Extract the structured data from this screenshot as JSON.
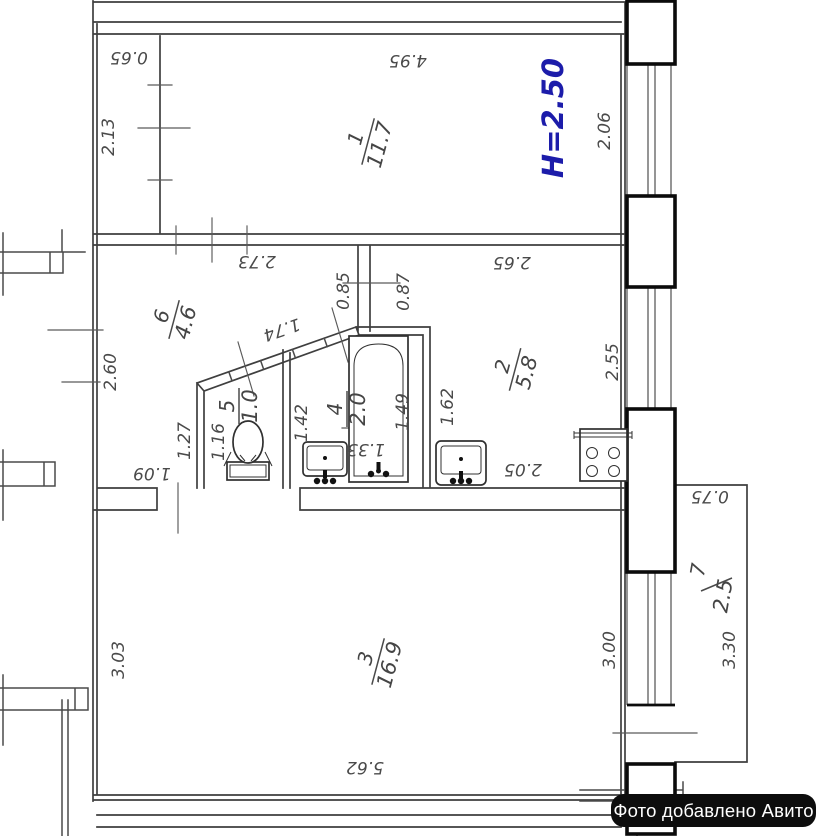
{
  "meta": {
    "badge_text": "Фото добавлено Авито"
  },
  "colors": {
    "accent_blue": "#1c1caa",
    "line": "#3f3f3f",
    "pier_black": "#0b0b0b",
    "badge_bg": "#0d0d0d",
    "badge_text": "#ffffff"
  },
  "ceiling_height": "H=2.50",
  "rooms": [
    {
      "number": "1",
      "area": "11.7"
    },
    {
      "number": "2",
      "area": "5.8"
    },
    {
      "number": "3",
      "area": "16.9"
    },
    {
      "number": "4",
      "area": "2.0"
    },
    {
      "number": "5",
      "area": "1.0"
    },
    {
      "number": "6",
      "area": "4.6"
    },
    {
      "number": "7",
      "area": "2.5"
    }
  ],
  "dimensions": {
    "strip_width": "0.65",
    "room1_width": "4.95",
    "room1_side": "2.13",
    "window_room1": "2.06",
    "corridor_top": "2.73",
    "kitchen_top": "2.65",
    "corridor_left": "2.60",
    "passage_left": "0.85",
    "passage_right": "0.87",
    "diagonal_wall": "1.74",
    "wc_offset": "1.27",
    "wc_width": "1.16",
    "bath_sink_width": "1.42",
    "bath_mid": "1.33",
    "tub_length": "1.49",
    "kitchen_sink_width": "1.62",
    "kitchen_bottom": "2.05",
    "kitchen_window": "2.55",
    "room3_door": "1.09",
    "room3_left": "3.03",
    "room3_bottom": "5.62",
    "wall_bottom_right": "3.00",
    "balcony_length": "3.30",
    "balcony_width": "0.75"
  }
}
